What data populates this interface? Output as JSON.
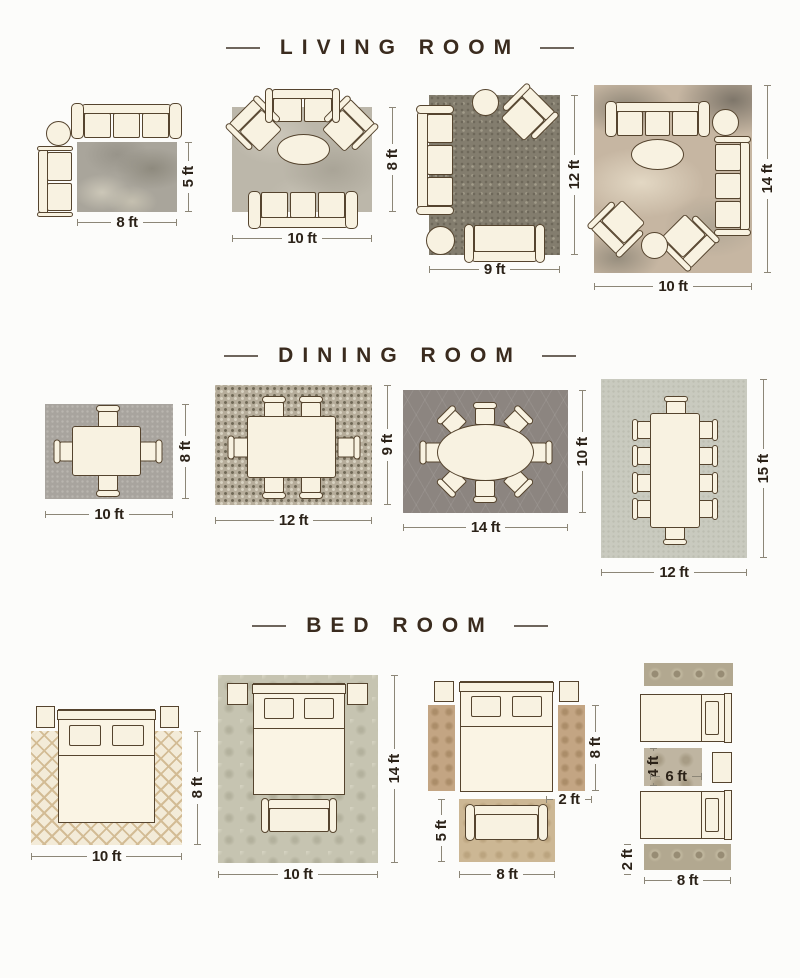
{
  "titles": {
    "living": "LIVING ROOM",
    "dining": "DINING ROOM",
    "bed": "BED ROOM"
  },
  "labels": {
    "lr1": {
      "w": "8 ft",
      "h": "5 ft"
    },
    "lr2": {
      "w": "10 ft",
      "h": "8 ft"
    },
    "lr3": {
      "w": "9 ft",
      "h": "12 ft"
    },
    "lr4": {
      "w": "10 ft",
      "h": "14 ft"
    },
    "dr1": {
      "w": "10 ft",
      "h": "8 ft"
    },
    "dr2": {
      "w": "12 ft",
      "h": "9 ft"
    },
    "dr3": {
      "w": "14 ft",
      "h": "10 ft"
    },
    "dr4": {
      "w": "12 ft",
      "h": "15 ft"
    },
    "br1": {
      "w": "10 ft",
      "h": "8 ft"
    },
    "br2": {
      "w": "10 ft",
      "h": "14 ft"
    },
    "br3": {
      "runner_len": "8 ft",
      "runner_w": "2 ft",
      "foot_h": "5 ft",
      "foot_w": "8 ft"
    },
    "br4": {
      "small_h": "4 ft",
      "small_w": "6 ft",
      "runner_w": "2 ft",
      "runner_len": "8 ft"
    }
  },
  "colors": {
    "background": "#fcfcfa",
    "title_text": "#3a2b1e",
    "label_text": "#2b2218",
    "dimension_line": "#8c8677",
    "furniture_fill": "#f8f2e1",
    "furniture_outline": "#55442e"
  }
}
